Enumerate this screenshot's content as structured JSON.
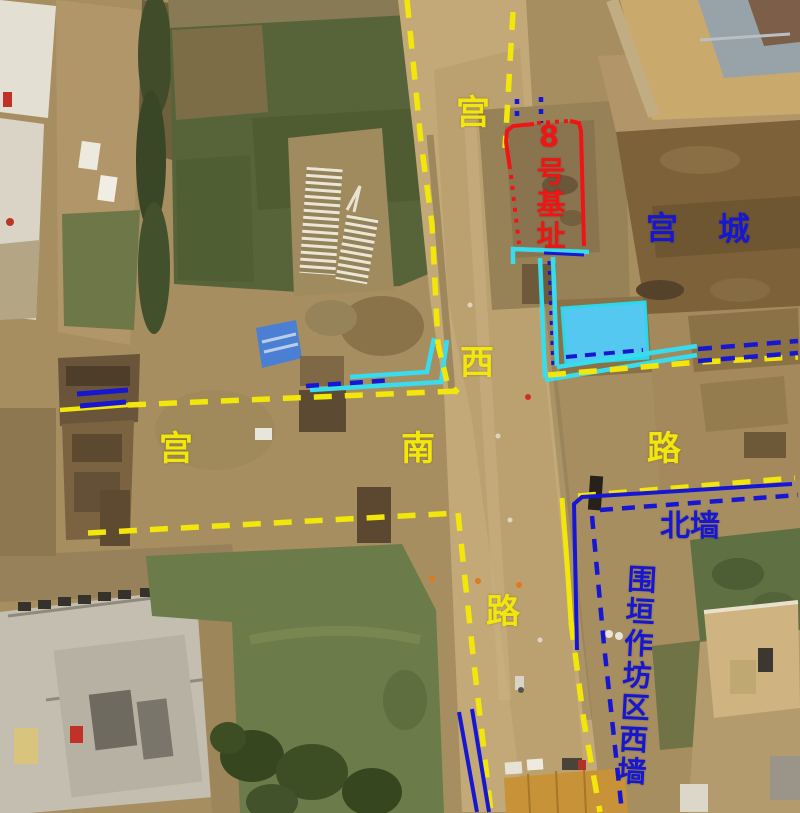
{
  "colors": {
    "yellow": "#f2e60a",
    "blue": "#1717d2",
    "cyan": "#38dcef",
    "red": "#ef1515",
    "pool_fill": "#54c8f0",
    "pool_stroke": "#2bd8ea"
  },
  "labels": [
    {
      "name": "road-label-gong-west",
      "text": "宫",
      "color": "yellow",
      "x": 473,
      "y": 113,
      "size": 34
    },
    {
      "name": "road-label-xi",
      "text": "西",
      "color": "yellow",
      "x": 477,
      "y": 363,
      "size": 34
    },
    {
      "name": "road-label-lu-west",
      "text": "路",
      "color": "yellow",
      "x": 503,
      "y": 612,
      "size": 34
    },
    {
      "name": "road-label-gong-south",
      "text": "宫",
      "color": "yellow",
      "x": 176,
      "y": 449,
      "size": 34
    },
    {
      "name": "road-label-nan",
      "text": "南",
      "color": "yellow",
      "x": 418,
      "y": 449,
      "size": 34
    },
    {
      "name": "road-label-lu-south",
      "text": "路",
      "color": "yellow",
      "x": 664,
      "y": 449,
      "size": 34
    },
    {
      "name": "site8-label",
      "text": "8号基址",
      "color": "red",
      "x": 548,
      "y": 186,
      "size": 29,
      "vertical": true
    },
    {
      "name": "palace-city-label-1",
      "text": "宫",
      "color": "blue",
      "x": 662,
      "y": 228,
      "size": 32
    },
    {
      "name": "palace-city-label-2",
      "text": "城",
      "color": "blue",
      "x": 734,
      "y": 229,
      "size": 32
    },
    {
      "name": "north-wall-label",
      "text": "北墙",
      "color": "blue",
      "x": 690,
      "y": 527,
      "size": 30
    },
    {
      "name": "workshop-wall-label",
      "text": "围垣作坊区西墙",
      "color": "blue",
      "x": 634,
      "y": 676,
      "size": 29,
      "vertical": true,
      "tilt": 3
    }
  ],
  "annotations": {
    "lines": [
      {
        "name": "drain-pool",
        "color": "pool_stroke",
        "fill": "pool_fill",
        "style": "solid",
        "width": 3,
        "close": true,
        "points": [
          [
            562,
            308
          ],
          [
            645,
            302
          ],
          [
            648,
            358
          ],
          [
            566,
            364
          ]
        ]
      },
      {
        "name": "drain-under-site8",
        "color": "cyan",
        "style": "solid",
        "width": 4.5,
        "points": [
          [
            513,
            264
          ],
          [
            513,
            249
          ],
          [
            589,
            252
          ]
        ]
      },
      {
        "name": "drain-channel-west-line",
        "color": "cyan",
        "style": "solid",
        "width": 4.5,
        "points": [
          [
            540,
            258
          ],
          [
            545,
            378
          ]
        ]
      },
      {
        "name": "drain-channel-east-line",
        "color": "cyan",
        "style": "solid",
        "width": 4.5,
        "points": [
          [
            553,
            257
          ],
          [
            557,
            366
          ]
        ]
      },
      {
        "name": "drain-east-run-lower",
        "color": "cyan",
        "style": "solid",
        "width": 4.5,
        "points": [
          [
            545,
            380
          ],
          [
            697,
            355
          ]
        ]
      },
      {
        "name": "drain-east-run-upper",
        "color": "cyan",
        "style": "solid",
        "width": 4.5,
        "points": [
          [
            557,
            367
          ],
          [
            697,
            346
          ]
        ]
      },
      {
        "name": "drain-west-run-upper",
        "color": "cyan",
        "style": "solid",
        "width": 4.5,
        "points": [
          [
            350,
            377
          ],
          [
            427,
            372
          ],
          [
            434,
            338
          ]
        ]
      },
      {
        "name": "drain-west-run-lower",
        "color": "cyan",
        "style": "solid",
        "width": 4.5,
        "points": [
          [
            310,
            390
          ],
          [
            441,
            382
          ],
          [
            447,
            340
          ]
        ]
      },
      {
        "name": "road-west-edge-north",
        "color": "yellow",
        "style": "dashed",
        "dash": "18 13",
        "width": 5.5,
        "points": [
          [
            407,
            0
          ],
          [
            421,
            142
          ],
          [
            432,
            224
          ],
          [
            438,
            344
          ]
        ]
      },
      {
        "name": "road-east-edge-north",
        "color": "yellow",
        "style": "dashed",
        "dash": "18 13",
        "width": 5.5,
        "points": [
          [
            513,
            12
          ],
          [
            505,
            148
          ]
        ]
      },
      {
        "name": "road-west-corner-jog",
        "color": "yellow",
        "style": "dashed",
        "dash": "14 10",
        "width": 5.5,
        "points": [
          [
            438,
            344
          ],
          [
            447,
            382
          ],
          [
            458,
            393
          ]
        ]
      },
      {
        "name": "south-road-north-edge-solid",
        "color": "yellow",
        "style": "solid",
        "width": 4.5,
        "points": [
          [
            60,
            410
          ],
          [
            128,
            405
          ]
        ]
      },
      {
        "name": "south-road-north-edge",
        "color": "yellow",
        "style": "dashed",
        "dash": "18 13",
        "width": 5.5,
        "points": [
          [
            128,
            405
          ],
          [
            458,
            391
          ]
        ]
      },
      {
        "name": "south-road-south-edge",
        "color": "yellow",
        "style": "dashed",
        "dash": "18 13",
        "width": 5.5,
        "points": [
          [
            88,
            533
          ],
          [
            458,
            513
          ]
        ]
      },
      {
        "name": "road-west-edge-south",
        "color": "yellow",
        "style": "dashed",
        "dash": "18 13",
        "width": 5.5,
        "points": [
          [
            458,
            513
          ],
          [
            473,
            655
          ],
          [
            491,
            812
          ]
        ]
      },
      {
        "name": "road-east-edge-south-solid",
        "color": "yellow",
        "style": "solid",
        "width": 5,
        "points": [
          [
            562,
            498
          ],
          [
            567,
            562
          ],
          [
            571,
            622
          ]
        ]
      },
      {
        "name": "road-east-edge-south",
        "color": "yellow",
        "style": "dashed",
        "dash": "18 13",
        "width": 5.5,
        "points": [
          [
            571,
            622
          ],
          [
            584,
            722
          ],
          [
            600,
            812
          ]
        ]
      },
      {
        "name": "east-road-north-edge",
        "color": "yellow",
        "style": "dashed",
        "dash": "18 13",
        "width": 5.5,
        "points": [
          [
            548,
            375
          ],
          [
            700,
            362
          ],
          [
            798,
            357
          ]
        ]
      },
      {
        "name": "east-road-south-edge",
        "color": "yellow",
        "style": "dashed",
        "dash": "18 13",
        "width": 5.5,
        "points": [
          [
            578,
            496
          ],
          [
            795,
            478
          ]
        ]
      },
      {
        "name": "palace-wall-bar-1",
        "color": "blue",
        "style": "solid",
        "width": 5,
        "points": [
          [
            77,
            394
          ],
          [
            128,
            390
          ]
        ]
      },
      {
        "name": "palace-wall-bar-2",
        "color": "blue",
        "style": "solid",
        "width": 5,
        "points": [
          [
            80,
            406
          ],
          [
            126,
            402
          ]
        ]
      },
      {
        "name": "palace-wall-mid-dashed",
        "color": "blue",
        "style": "dashed",
        "dash": "13 9",
        "width": 4.5,
        "points": [
          [
            306,
            386
          ],
          [
            393,
            380
          ]
        ]
      },
      {
        "name": "north-wall-line",
        "color": "blue",
        "style": "solid",
        "width": 4,
        "points": [
          [
            792,
            484
          ],
          [
            582,
            497
          ],
          [
            574,
            504
          ],
          [
            577,
            650
          ]
        ]
      },
      {
        "name": "north-wall-dashed-south",
        "color": "blue",
        "style": "dashed",
        "dash": "13 9",
        "width": 4.5,
        "points": [
          [
            600,
            510
          ],
          [
            798,
            495
          ]
        ]
      },
      {
        "name": "workshop-west-wall-dashed",
        "color": "blue",
        "style": "dashed",
        "dash": "13 10",
        "width": 4.5,
        "points": [
          [
            592,
            516
          ],
          [
            604,
            645
          ],
          [
            622,
            812
          ]
        ]
      },
      {
        "name": "east-wall-dashed-1",
        "color": "blue",
        "style": "dashed",
        "dash": "14 9",
        "width": 4.5,
        "points": [
          [
            698,
            349
          ],
          [
            798,
            341
          ]
        ]
      },
      {
        "name": "east-wall-dashed-2",
        "color": "blue",
        "style": "dashed",
        "dash": "14 9",
        "width": 4.5,
        "points": [
          [
            698,
            361
          ],
          [
            798,
            353
          ]
        ]
      },
      {
        "name": "pool-south-dashed",
        "color": "blue",
        "style": "dashed",
        "dash": "11 8",
        "width": 4,
        "points": [
          [
            566,
            357
          ],
          [
            643,
            350
          ]
        ]
      },
      {
        "name": "drain-blue-under-site8",
        "color": "blue",
        "style": "solid",
        "width": 3,
        "points": [
          [
            544,
            253
          ],
          [
            584,
            255
          ]
        ]
      },
      {
        "name": "drain-blue-dotted",
        "color": "blue",
        "style": "dotted",
        "dash": "4 6",
        "width": 3,
        "points": [
          [
            549,
            261
          ],
          [
            553,
            370
          ]
        ]
      },
      {
        "name": "site8-north-dots-1",
        "color": "blue",
        "style": "dotted",
        "dash": "5 7",
        "width": 4.5,
        "points": [
          [
            517,
            99
          ],
          [
            517,
            123
          ]
        ]
      },
      {
        "name": "site8-north-dots-2",
        "color": "blue",
        "style": "dotted",
        "dash": "5 7",
        "width": 4.5,
        "points": [
          [
            541,
            97
          ],
          [
            541,
            123
          ]
        ]
      },
      {
        "name": "road-bottom-line-1",
        "color": "blue",
        "style": "solid",
        "width": 4,
        "points": [
          [
            459,
            712
          ],
          [
            477,
            812
          ]
        ]
      },
      {
        "name": "road-bottom-line-2",
        "color": "blue",
        "style": "solid",
        "width": 4,
        "points": [
          [
            472,
            709
          ],
          [
            489,
            812
          ]
        ]
      },
      {
        "name": "site8-top-left-corner",
        "color": "red",
        "style": "solid",
        "width": 4,
        "points": [
          [
            506,
            142
          ],
          [
            507,
            131
          ],
          [
            513,
            126
          ],
          [
            534,
            124
          ]
        ]
      },
      {
        "name": "site8-top-dotted",
        "color": "red",
        "style": "dotted",
        "dash": "4 5",
        "width": 4,
        "points": [
          [
            537,
            123
          ],
          [
            569,
            121
          ]
        ]
      },
      {
        "name": "site8-right-edge",
        "color": "red",
        "style": "solid",
        "width": 4,
        "points": [
          [
            570,
            121
          ],
          [
            579,
            123
          ],
          [
            581,
            131
          ],
          [
            584,
            246
          ]
        ]
      },
      {
        "name": "site8-left-solid",
        "color": "red",
        "style": "solid",
        "width": 4,
        "points": [
          [
            506,
            142
          ],
          [
            510,
            169
          ]
        ]
      },
      {
        "name": "site8-left-dotted",
        "color": "red",
        "style": "dotted",
        "dash": "4 7",
        "width": 4,
        "points": [
          [
            511,
            175
          ],
          [
            519,
            244
          ]
        ]
      }
    ]
  }
}
